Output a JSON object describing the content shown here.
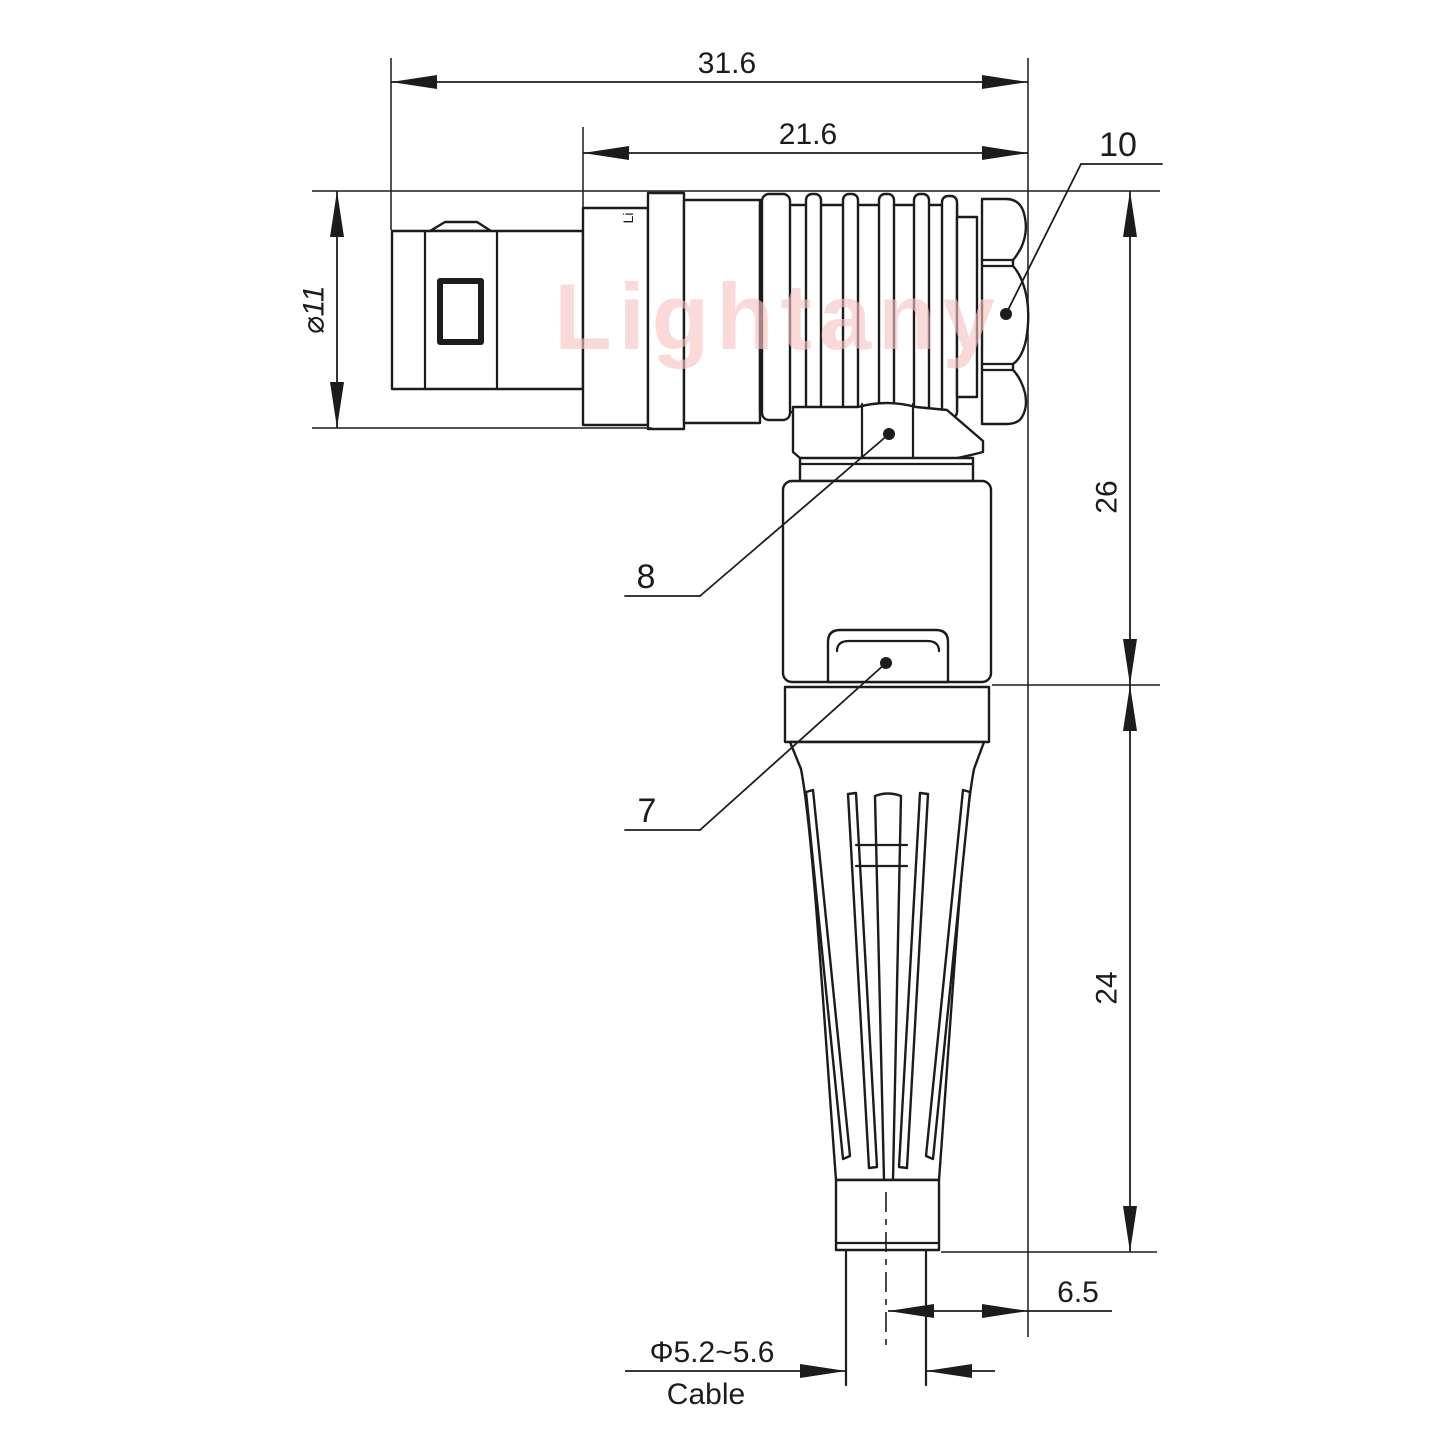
{
  "watermark": {
    "text": "Lightany"
  },
  "part_marking": {
    "text": "Li"
  },
  "dimensions": {
    "overall_length": "31.6",
    "rear_length": "21.6",
    "plug_diameter": "⌀11",
    "right_height_upper": "26",
    "right_height_lower": "24",
    "cable_center_offset": "6.5",
    "cable_diameter": "Φ5.2~5.6",
    "cable_label": "Cable"
  },
  "callouts": {
    "coupling_nut": "10",
    "back_nut": "8",
    "latch_button": "7"
  },
  "colors": {
    "line": "#1c1c1c",
    "watermark": "#f7c3c3",
    "background": "#ffffff"
  }
}
